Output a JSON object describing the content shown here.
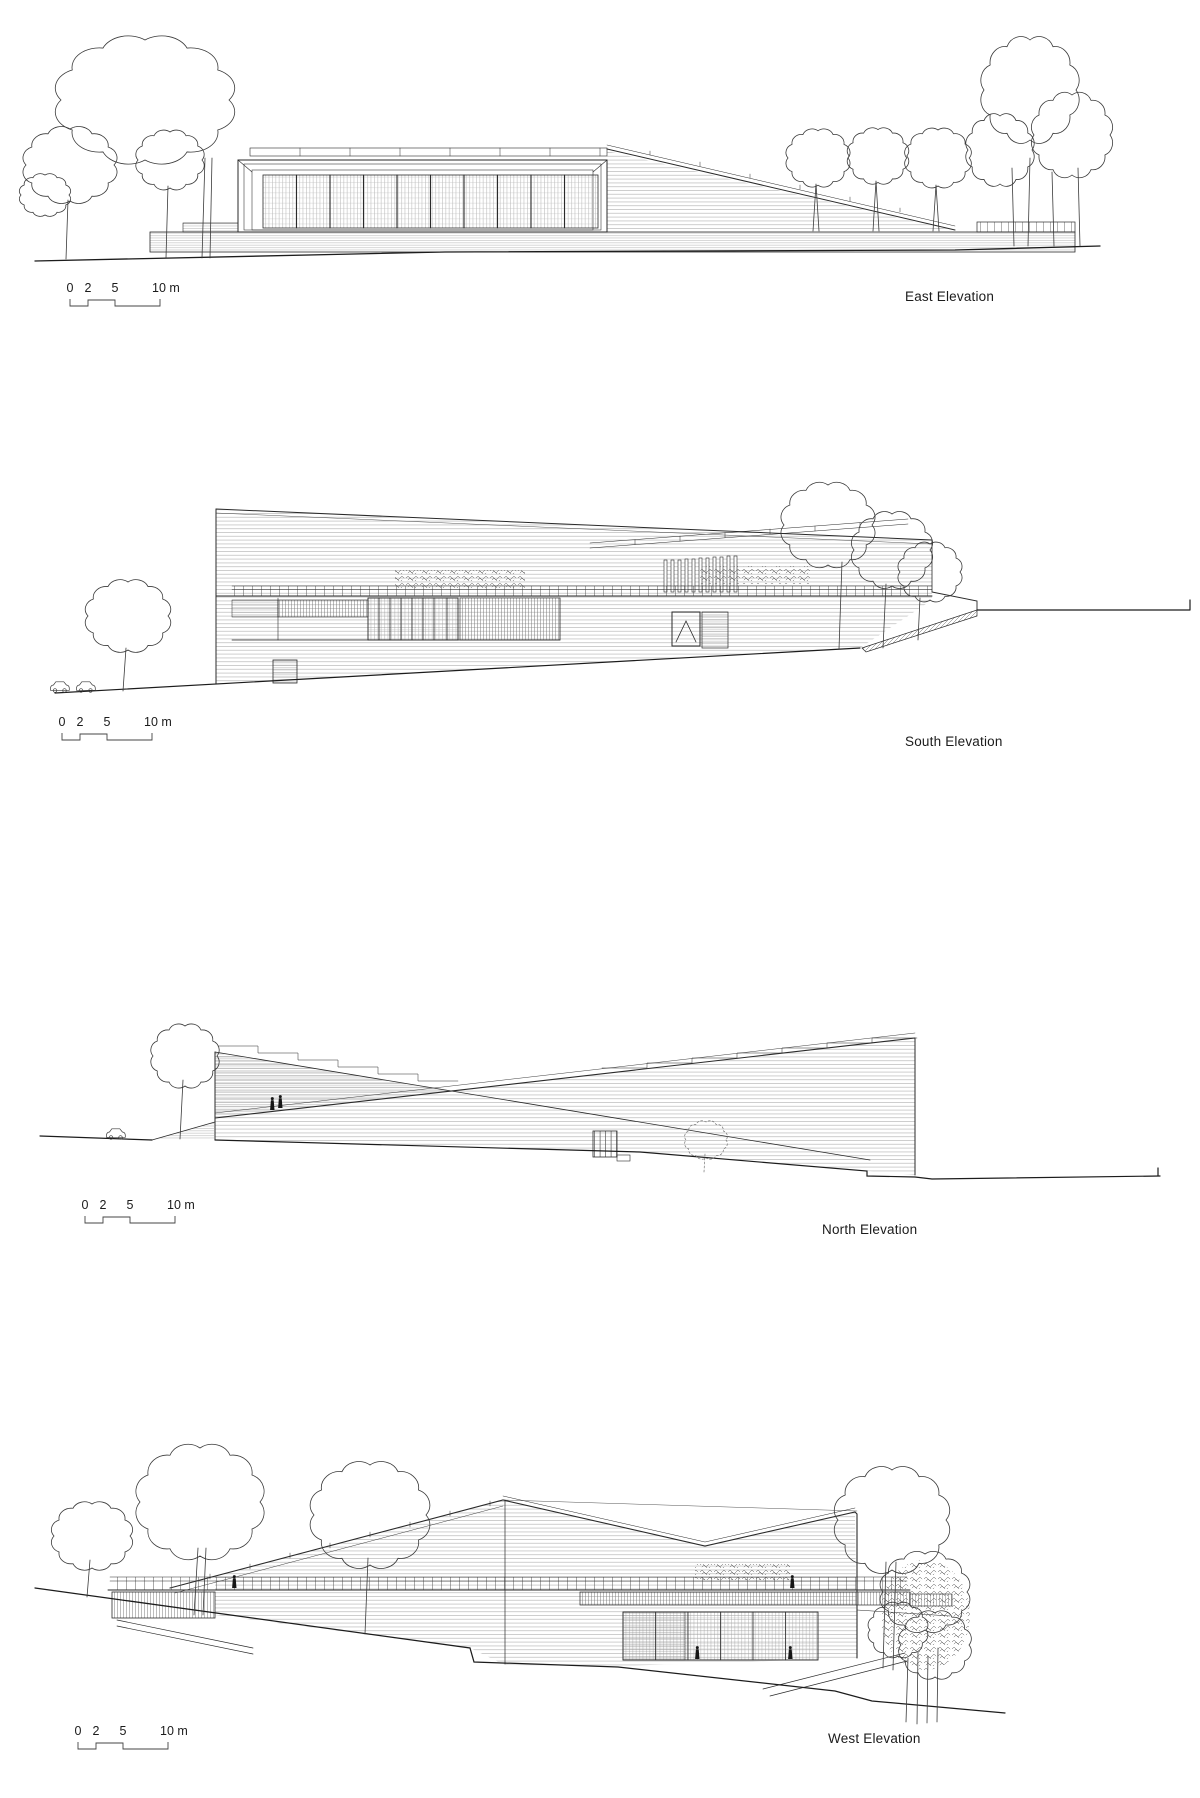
{
  "sheet": {
    "background_color": "#ffffff",
    "line_color": "#2a2a2a",
    "drawing_type": "architectural elevations"
  },
  "elevations": [
    {
      "id": "east",
      "label": "East Elevation",
      "scale_bar": {
        "labels": [
          "0",
          "2",
          "5",
          "10 m"
        ]
      }
    },
    {
      "id": "south",
      "label": "South Elevation",
      "scale_bar": {
        "labels": [
          "0",
          "2",
          "5",
          "10 m"
        ]
      }
    },
    {
      "id": "north",
      "label": "North Elevation",
      "scale_bar": {
        "labels": [
          "0",
          "2",
          "5",
          "10 m"
        ]
      }
    },
    {
      "id": "west",
      "label": "West Elevation",
      "scale_bar": {
        "labels": [
          "0",
          "2",
          "5",
          "10 m"
        ]
      }
    }
  ]
}
